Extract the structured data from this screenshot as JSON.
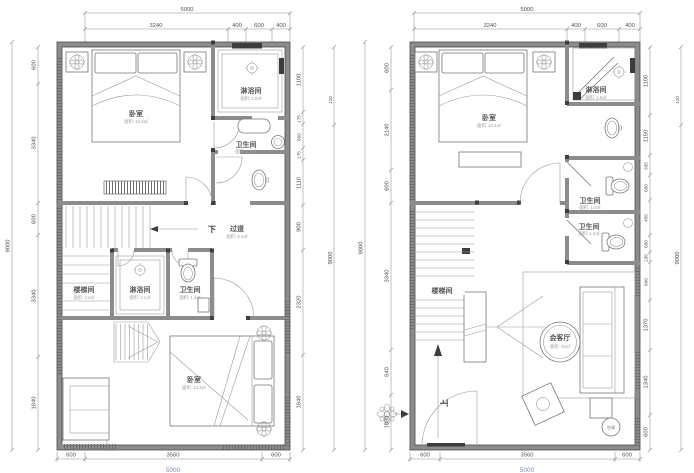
{
  "colors": {
    "background": "#ffffff",
    "wall_fill": "#8c8c8c",
    "wall_edge": "#4a4a4a",
    "dim_text": "#4f4f4f",
    "area_text": "#9a9a9a",
    "blue_dim_text": "#7a8fc0"
  },
  "left": {
    "dims_top": [
      "5000",
      "3240",
      "400",
      "600",
      "400"
    ],
    "dims_left": [
      "9000",
      "600",
      "3340",
      "600",
      "3340",
      "1840"
    ],
    "dims_right": [
      "1100",
      "175",
      "600",
      "175",
      "1110",
      "900",
      "2320",
      "1840"
    ],
    "dims_right_outer": [
      "120",
      "9000"
    ],
    "dims_bottom": [
      "600",
      "3560",
      "600"
    ],
    "dims_bottom_total": "5000",
    "rooms": {
      "bedroom_top": {
        "name": "卧室",
        "area": "面积: 16.3㎡"
      },
      "shower_top": {
        "name": "淋浴间",
        "area": "面积: 1.5㎡"
      },
      "toilet_top": {
        "name": "卫生间",
        "area": "面积: 1.4㎡"
      },
      "corridor": {
        "name": "过道",
        "area": "面积: 5.4㎡"
      },
      "stair": {
        "name": "楼梯间",
        "area": "面积: 3.4㎡"
      },
      "shower_mid": {
        "name": "淋浴间",
        "area": "面积: 2.1㎡"
      },
      "toilet_mid": {
        "name": "卫生间",
        "area": "面积: 1.4㎡"
      },
      "bedroom_bottom": {
        "name": "卧室",
        "area": "面积: 14.3㎡"
      }
    },
    "down_label": "下"
  },
  "right": {
    "dims_top": [
      "5000",
      "3240",
      "400",
      "600",
      "400"
    ],
    "dims_left": [
      "9000",
      "600",
      "2140",
      "600",
      "3340",
      "840",
      "1080"
    ],
    "dims_right": [
      "1100",
      "1150",
      "335",
      "600",
      "455",
      "600",
      "235",
      "600",
      "1370",
      "1340",
      "600"
    ],
    "dims_right_outer": [
      "120",
      "9000"
    ],
    "dims_bottom": [
      "600",
      "3560",
      "600"
    ],
    "dims_bottom_total": "5000",
    "rooms": {
      "bedroom": {
        "name": "卧室",
        "area": "面积: 12.4㎡"
      },
      "shower": {
        "name": "淋浴间",
        "area": "面积: 1.5㎡"
      },
      "toilet_a": {
        "name": "卫生间",
        "area": "面积: 1.4㎡"
      },
      "toilet_b": {
        "name": "卫生间",
        "area": "面积: 1.3㎡"
      },
      "stair": {
        "name": "楼梯间"
      },
      "living": {
        "name": "会客厅",
        "area": "面积: 19㎡"
      },
      "ac": "空调"
    },
    "up_label": "上"
  }
}
